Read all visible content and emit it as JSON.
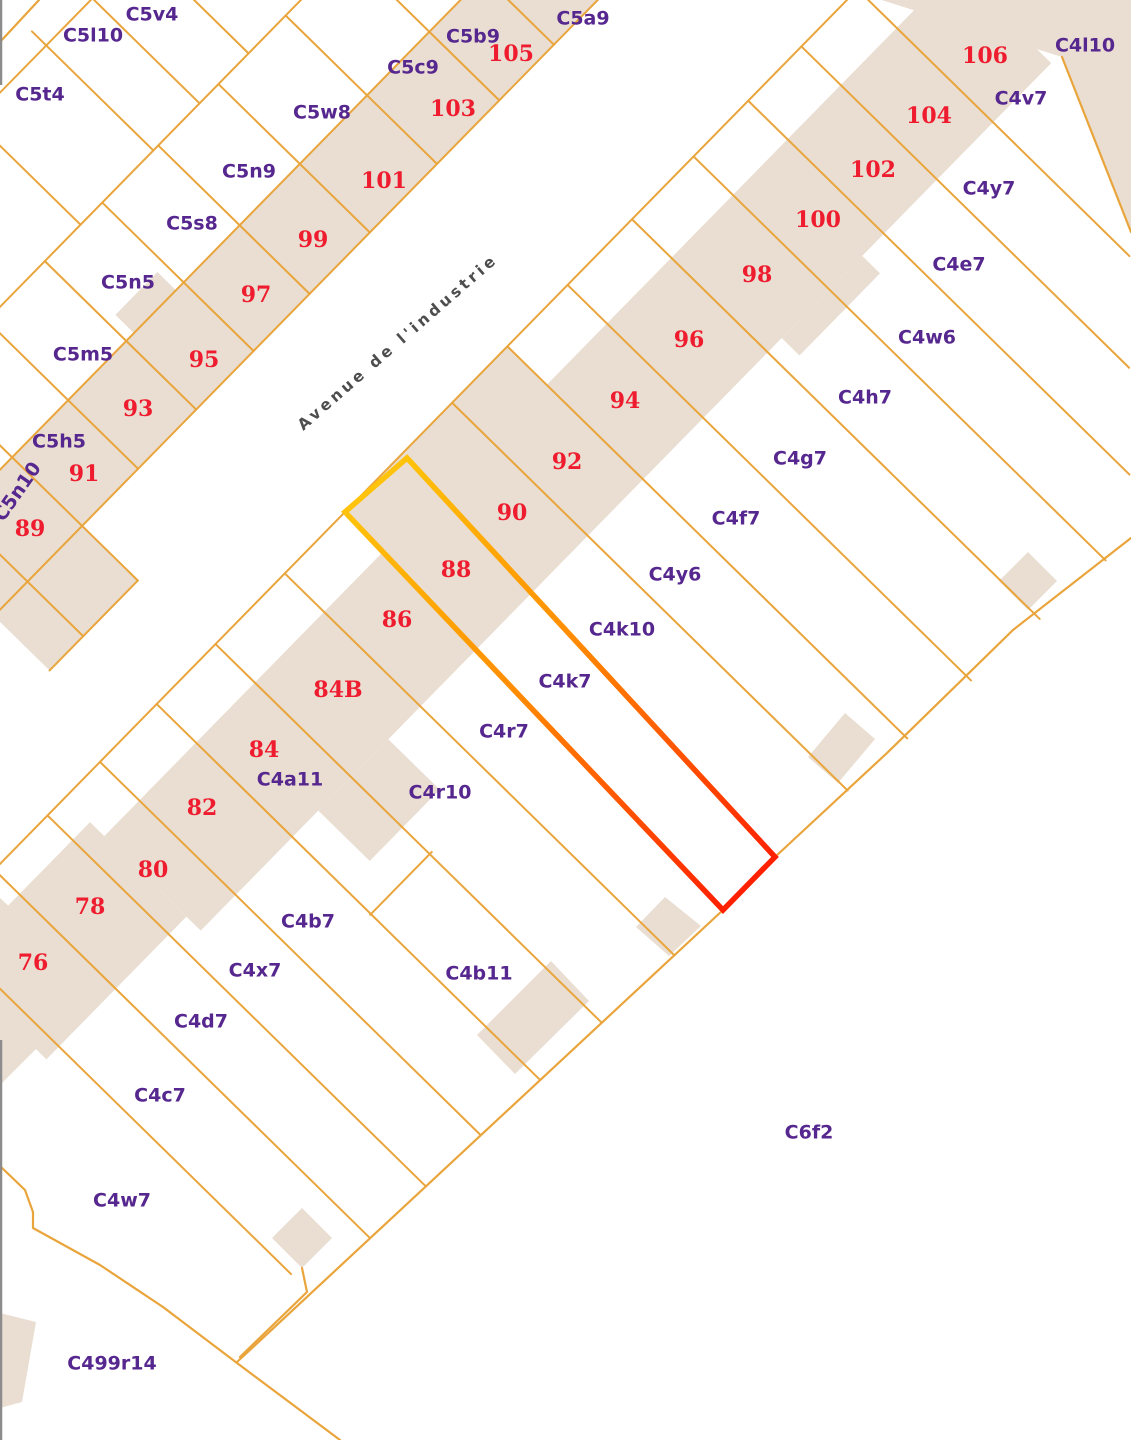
{
  "map": {
    "width": 1131,
    "height": 1440,
    "colors": {
      "background": "#ffffff",
      "parcel_line": "#E9A53C",
      "building_fill": "#E9DED1",
      "number_label": "#EE1C2E",
      "code_label": "#56278E",
      "street_label": "#4D4D4D",
      "street_halo": "#FFFFFF",
      "highlight_start": "#FFC30B",
      "highlight_mid": "#FF8C00",
      "highlight_end": "#FF2000",
      "map_edge": "#8C8C8C"
    },
    "frame": {
      "origin": [
        345,
        512
      ],
      "u": [
        0.7,
        -0.714
      ],
      "v": [
        0.714,
        0.7
      ]
    },
    "street": {
      "name": "Avenue de l'industrie",
      "x": 401,
      "y": 346,
      "angle": -41
    },
    "selected_parcel": {
      "number": "88",
      "points": [
        [
          407,
          458
        ],
        [
          345,
          512
        ],
        [
          723,
          910
        ],
        [
          775,
          857
        ]
      ],
      "gradient": {
        "x1": 376,
        "y1": 485,
        "x2": 749,
        "y2": 884
      },
      "stroke_width": 5.5
    },
    "strips_st": [
      {
        "name": "left-building-strip",
        "s": [
          -320,
          560
        ],
        "t": [
          -276,
          -178
        ]
      },
      {
        "name": "left-strip-bump",
        "s": [
          -20,
          40
        ],
        "t": [
          -302,
          -276
        ]
      },
      {
        "name": "left-strip-low",
        "s": [
          -320,
          -194
        ],
        "t": [
          -178,
          -100
        ]
      },
      {
        "name": "right-strip-76-78",
        "s": [
          -600,
          -400
        ],
        "t": [
          35,
          170
        ]
      },
      {
        "name": "right-strip-80-84",
        "s": [
          -400,
          -86
        ],
        "t": [
          55,
          190
        ]
      },
      {
        "name": "right-strip-86",
        "s": [
          -86,
          0
        ],
        "t": [
          55,
          190
        ]
      },
      {
        "name": "right-strip-88-92",
        "s": [
          0,
          232
        ],
        "t": [
          0,
          190
        ]
      },
      {
        "name": "right-strip-94-106",
        "s": [
          232,
          815
        ],
        "t": [
          55,
          190
        ]
      },
      {
        "name": "right-strip-84-deep",
        "s": [
          -232,
          -132
        ],
        "t": [
          190,
          262
        ]
      },
      {
        "name": "right-strip-98-step",
        "s": [
          430,
          545
        ],
        "t": [
          190,
          215
        ]
      }
    ],
    "shapes_px": [
      {
        "name": "corner-block-c4l10",
        "pts": [
          [
            850,
            -10
          ],
          [
            1131,
            -10
          ],
          [
            1131,
            232
          ],
          [
            1062,
            57
          ]
        ]
      },
      {
        "name": "building-c4h7",
        "pts": [
          [
            999,
            581
          ],
          [
            1028,
            552
          ],
          [
            1057,
            581
          ],
          [
            1028,
            610
          ]
        ]
      },
      {
        "name": "building-c4g7",
        "pts": [
          [
            808,
            757
          ],
          [
            845,
            713
          ],
          [
            875,
            739
          ],
          [
            838,
            783
          ]
        ]
      },
      {
        "name": "building-c4y6",
        "pts": [
          [
            636,
            927
          ],
          [
            665,
            897
          ],
          [
            701,
            926
          ],
          [
            669,
            956
          ]
        ]
      },
      {
        "name": "building-c4b11",
        "pts": [
          [
            477,
            1035
          ],
          [
            551,
            961
          ],
          [
            589,
            1001
          ],
          [
            515,
            1074
          ]
        ]
      },
      {
        "name": "building-c4w7",
        "pts": [
          [
            272,
            1238
          ],
          [
            302,
            1208
          ],
          [
            332,
            1238
          ],
          [
            302,
            1268
          ]
        ]
      },
      {
        "name": "building-c499r14",
        "pts": [
          [
            0,
            1313
          ],
          [
            36,
            1322
          ],
          [
            22,
            1402
          ],
          [
            0,
            1408
          ]
        ]
      },
      {
        "name": "building-76-edge",
        "pts": [
          [
            0,
            898
          ],
          [
            40,
            935
          ],
          [
            40,
            1045
          ],
          [
            0,
            1085
          ]
        ]
      }
    ],
    "lines_u": [
      {
        "t": 0,
        "s": [
          -493,
          760
        ]
      },
      {
        "t": -178,
        "s": [
          -330,
          560
        ]
      },
      {
        "t": -276,
        "s": [
          -330,
          470
        ]
      },
      {
        "t": -390,
        "s": [
          -330,
          360
        ]
      },
      {
        "t": -540,
        "s": [
          -150,
          200
        ]
      },
      {
        "t": -100,
        "s": [
          -320,
          -194
        ]
      },
      {
        "t": 300,
        "s": [
          -270,
          -182
        ]
      }
    ],
    "lines_v": [
      {
        "s": -272,
        "t": [
          -390,
          -100
        ]
      },
      {
        "s": -194,
        "t": [
          -390,
          -100
        ]
      },
      {
        "s": -114,
        "t": [
          -390,
          -178
        ]
      },
      {
        "s": -31,
        "t": [
          -390,
          -178
        ]
      },
      {
        "s": 51,
        "t": [
          -390,
          -178
        ]
      },
      {
        "s": 131,
        "t": [
          -390,
          -178
        ]
      },
      {
        "s": 217,
        "t": [
          -390,
          -178
        ]
      },
      {
        "s": 313,
        "t": [
          -390,
          -178
        ]
      },
      {
        "s": 402,
        "t": [
          -390,
          -178
        ]
      },
      {
        "s": 480,
        "t": [
          -390,
          -178
        ]
      },
      {
        "s": 20,
        "t": [
          -560,
          -390
        ]
      },
      {
        "s": 124,
        "t": [
          -560,
          -390
        ]
      },
      {
        "s": 190,
        "t": [
          -560,
          -390
        ]
      },
      {
        "s": 260,
        "t": [
          -540,
          -390
        ]
      },
      {
        "s": -582,
        "t": [
          0,
          495
        ]
      },
      {
        "s": -501,
        "t": [
          0,
          526
        ]
      },
      {
        "s": -425,
        "t": [
          0,
          530
        ]
      },
      {
        "s": -350,
        "t": [
          0,
          533
        ]
      },
      {
        "s": -269,
        "t": [
          0,
          537
        ]
      },
      {
        "s": -185,
        "t": [
          0,
          540
        ]
      },
      {
        "s": -86,
        "t": [
          0,
          545
        ]
      },
      {
        "s": 153,
        "t": [
          0,
          554
        ]
      },
      {
        "s": 232,
        "t": [
          0,
          560
        ]
      },
      {
        "s": 318,
        "t": [
          0,
          565
        ]
      },
      {
        "s": 410,
        "t": [
          0,
          571
        ]
      },
      {
        "s": 498,
        "t": [
          0,
          577
        ]
      },
      {
        "s": 576,
        "t": [
          0,
          534
        ]
      },
      {
        "s": 652,
        "t": [
          0,
          459
        ]
      },
      {
        "s": 732,
        "t": [
          0,
          381
        ]
      }
    ],
    "polylines_px": [
      {
        "name": "block-se-boundary",
        "pts": [
          [
            237,
            1362
          ],
          [
            723,
            910
          ],
          [
            775,
            857
          ],
          [
            887,
            753
          ],
          [
            1013,
            630
          ],
          [
            1131,
            538
          ]
        ]
      },
      {
        "name": "road-boundary-southwest",
        "pts": [
          [
            0,
            1166
          ],
          [
            25,
            1190
          ],
          [
            33,
            1212
          ],
          [
            33,
            1228
          ],
          [
            100,
            1265
          ],
          [
            163,
            1307
          ],
          [
            237,
            1363
          ],
          [
            340,
            1440
          ]
        ]
      },
      {
        "name": "boundary-wedge",
        "pts": [
          [
            302,
            1268
          ],
          [
            307,
            1292
          ],
          [
            240,
            1357
          ]
        ]
      },
      {
        "name": "boundary-top-left-corner",
        "pts": [
          [
            0,
            42
          ],
          [
            39,
            0
          ]
        ]
      },
      {
        "name": "boundary-c4l10-east",
        "pts": [
          [
            1062,
            57
          ],
          [
            1131,
            232
          ]
        ]
      }
    ],
    "edge_segments": [
      [
        0,
        85
      ],
      [
        1040,
        1440
      ]
    ],
    "labels": {
      "numbers": [
        {
          "text": "76",
          "x": 33,
          "y": 964
        },
        {
          "text": "78",
          "x": 90,
          "y": 908
        },
        {
          "text": "80",
          "x": 153,
          "y": 871
        },
        {
          "text": "82",
          "x": 202,
          "y": 809
        },
        {
          "text": "84",
          "x": 264,
          "y": 751
        },
        {
          "text": "84B",
          "x": 338,
          "y": 691
        },
        {
          "text": "86",
          "x": 397,
          "y": 621
        },
        {
          "text": "88",
          "x": 456,
          "y": 571
        },
        {
          "text": "90",
          "x": 512,
          "y": 514
        },
        {
          "text": "92",
          "x": 567,
          "y": 463
        },
        {
          "text": "94",
          "x": 625,
          "y": 402
        },
        {
          "text": "96",
          "x": 689,
          "y": 341
        },
        {
          "text": "98",
          "x": 757,
          "y": 276
        },
        {
          "text": "100",
          "x": 818,
          "y": 221
        },
        {
          "text": "102",
          "x": 873,
          "y": 171
        },
        {
          "text": "104",
          "x": 929,
          "y": 117
        },
        {
          "text": "106",
          "x": 985,
          "y": 57
        },
        {
          "text": "89",
          "x": 30,
          "y": 530
        },
        {
          "text": "91",
          "x": 84,
          "y": 475
        },
        {
          "text": "93",
          "x": 138,
          "y": 410
        },
        {
          "text": "95",
          "x": 204,
          "y": 361
        },
        {
          "text": "97",
          "x": 256,
          "y": 296
        },
        {
          "text": "99",
          "x": 313,
          "y": 241
        },
        {
          "text": "101",
          "x": 384,
          "y": 182
        },
        {
          "text": "103",
          "x": 453,
          "y": 110
        },
        {
          "text": "105",
          "x": 511,
          "y": 55
        }
      ],
      "codes": [
        {
          "text": "C5v4",
          "x": 152,
          "y": 15
        },
        {
          "text": "C5l10",
          "x": 93,
          "y": 36
        },
        {
          "text": "C5t4",
          "x": 40,
          "y": 95
        },
        {
          "text": "C5a9",
          "x": 583,
          "y": 19
        },
        {
          "text": "C5b9",
          "x": 473,
          "y": 37
        },
        {
          "text": "C5c9",
          "x": 413,
          "y": 68
        },
        {
          "text": "C5w8",
          "x": 322,
          "y": 113
        },
        {
          "text": "C5n9",
          "x": 249,
          "y": 172
        },
        {
          "text": "C5s8",
          "x": 192,
          "y": 224
        },
        {
          "text": "C5n5",
          "x": 128,
          "y": 283
        },
        {
          "text": "C5m5",
          "x": 83,
          "y": 355
        },
        {
          "text": "C5h5",
          "x": 59,
          "y": 442
        },
        {
          "text": "C5n10",
          "x": 18,
          "y": 492,
          "angle": -55
        },
        {
          "text": "C4l10",
          "x": 1085,
          "y": 46
        },
        {
          "text": "C4v7",
          "x": 1021,
          "y": 99
        },
        {
          "text": "C4y7",
          "x": 989,
          "y": 189
        },
        {
          "text": "C4e7",
          "x": 959,
          "y": 265
        },
        {
          "text": "C4w6",
          "x": 927,
          "y": 338
        },
        {
          "text": "C4h7",
          "x": 865,
          "y": 398
        },
        {
          "text": "C4g7",
          "x": 800,
          "y": 459
        },
        {
          "text": "C4f7",
          "x": 736,
          "y": 519
        },
        {
          "text": "C4y6",
          "x": 675,
          "y": 575
        },
        {
          "text": "C4k10",
          "x": 622,
          "y": 630
        },
        {
          "text": "C4k7",
          "x": 565,
          "y": 682
        },
        {
          "text": "C4r7",
          "x": 504,
          "y": 732
        },
        {
          "text": "C4r10",
          "x": 440,
          "y": 793
        },
        {
          "text": "C4a11",
          "x": 290,
          "y": 780
        },
        {
          "text": "C4b7",
          "x": 308,
          "y": 922
        },
        {
          "text": "C4x7",
          "x": 255,
          "y": 971
        },
        {
          "text": "C4b11",
          "x": 479,
          "y": 974
        },
        {
          "text": "C4d7",
          "x": 201,
          "y": 1022
        },
        {
          "text": "C4c7",
          "x": 160,
          "y": 1096
        },
        {
          "text": "C4w7",
          "x": 122,
          "y": 1201
        },
        {
          "text": "C499r14",
          "x": 112,
          "y": 1364
        },
        {
          "text": "C6f2",
          "x": 809,
          "y": 1133
        }
      ]
    }
  }
}
